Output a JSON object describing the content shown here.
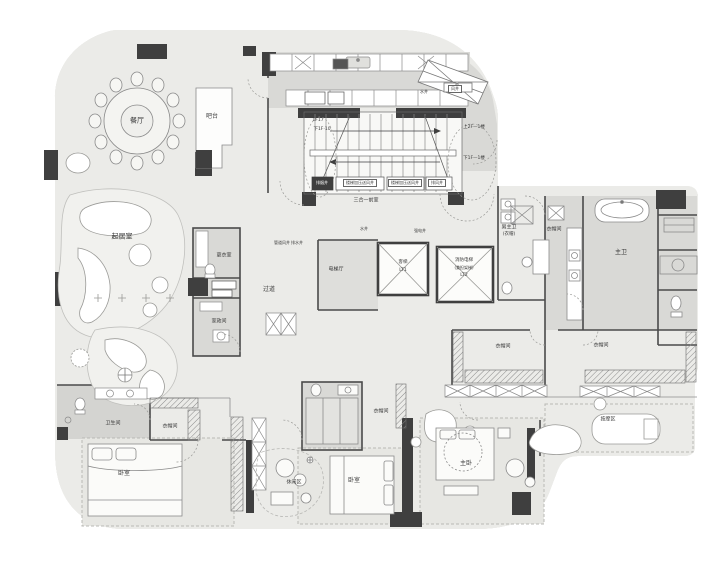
{
  "document": {
    "type": "residential interior floor plan drawing",
    "language": "zh-CN"
  },
  "colors": {
    "background": "#ffffff",
    "floor": "#ebebe8",
    "wet_area": "#d9d9d6",
    "rug": "#e7e7e3",
    "wall_dark": "#3f3f3f",
    "line": "#8c8c8c",
    "furniture_fill": "#fbfbf9"
  },
  "rooms": [
    {
      "id": "dining-room",
      "label": "餐厅",
      "x": 137,
      "y": 121,
      "size": 7
    },
    {
      "id": "bar-counter",
      "label": "吧台",
      "x": 212,
      "y": 117,
      "size": 6
    },
    {
      "id": "living-room",
      "label": "起居室",
      "x": 122,
      "y": 237,
      "size": 7
    },
    {
      "id": "dressing-room",
      "label": "更衣室",
      "x": 224,
      "y": 256,
      "size": 5
    },
    {
      "id": "laundry-room",
      "label": "家政间",
      "x": 219,
      "y": 322,
      "size": 5
    },
    {
      "id": "corridor",
      "label": "过道",
      "x": 269,
      "y": 290,
      "size": 6
    },
    {
      "id": "elevator-hall",
      "label": "电梯厅",
      "x": 336,
      "y": 270,
      "size": 5
    },
    {
      "id": "vestibule",
      "label": "三合一前室",
      "x": 366,
      "y": 201,
      "size": 5
    },
    {
      "id": "male-master-bath",
      "label": "男主卫",
      "x": 509,
      "y": 228,
      "size": 5
    },
    {
      "id": "male-master-bath-sub",
      "label": "(衣帽)",
      "x": 509,
      "y": 235,
      "size": 4.5
    },
    {
      "id": "closet-a",
      "label": "衣帽间",
      "x": 554,
      "y": 230,
      "size": 5
    },
    {
      "id": "master-bath",
      "label": "主卫",
      "x": 621,
      "y": 253,
      "size": 6
    },
    {
      "id": "closet-b",
      "label": "衣帽间",
      "x": 503,
      "y": 347,
      "size": 5
    },
    {
      "id": "closet-c",
      "label": "衣帽间",
      "x": 601,
      "y": 346,
      "size": 5
    },
    {
      "id": "massage-area",
      "label": "按摩区",
      "x": 608,
      "y": 420,
      "size": 5
    },
    {
      "id": "master-bedroom",
      "label": "主卧",
      "x": 466,
      "y": 464,
      "size": 6
    },
    {
      "id": "bedroom-2",
      "label": "卧室",
      "x": 354,
      "y": 481,
      "size": 6
    },
    {
      "id": "leisure-area",
      "label": "休闲区",
      "x": 294,
      "y": 483,
      "size": 5
    },
    {
      "id": "bedroom-3",
      "label": "卧室",
      "x": 124,
      "y": 474,
      "size": 6
    },
    {
      "id": "bathroom-2",
      "label": "卫生间",
      "x": 113,
      "y": 424,
      "size": 5
    },
    {
      "id": "closet-d",
      "label": "衣帽间",
      "x": 170,
      "y": 427,
      "size": 5
    },
    {
      "id": "closet-e",
      "label": "衣帽间",
      "x": 381,
      "y": 412,
      "size": 5
    }
  ],
  "annotations": [
    {
      "id": "stair-up-note",
      "label": "上2F—1楼",
      "x": 474,
      "y": 128,
      "size": 4.5,
      "style": ""
    },
    {
      "id": "stair-down-note",
      "label": "下1F—1楼",
      "x": 474,
      "y": 159,
      "size": 4.5,
      "style": ""
    },
    {
      "id": "stair-up-note-2",
      "label": "1F17",
      "x": 318,
      "y": 121,
      "size": 4.5,
      "style": ""
    },
    {
      "id": "stair-down-note-2",
      "label": "下1F·10",
      "x": 322,
      "y": 130,
      "size": 4.5,
      "style": ""
    },
    {
      "id": "shaft-smoke",
      "label": "排烟井",
      "x": 322,
      "y": 183,
      "size": 4,
      "style": "dark"
    },
    {
      "id": "shaft-stair-press-1",
      "label": "楼梯加压送风井",
      "x": 360,
      "y": 183,
      "size": 4,
      "style": "box"
    },
    {
      "id": "shaft-stair-press-2",
      "label": "楼梯加压送风井",
      "x": 405,
      "y": 183,
      "size": 4,
      "style": "box"
    },
    {
      "id": "shaft-exhaust",
      "label": "排风井",
      "x": 437,
      "y": 183,
      "size": 4,
      "style": "box"
    },
    {
      "id": "shaft-water",
      "label": "水井",
      "x": 364,
      "y": 229,
      "size": 4,
      "style": ""
    },
    {
      "id": "shaft-power",
      "label": "强电井",
      "x": 420,
      "y": 231,
      "size": 4,
      "style": ""
    },
    {
      "id": "shaft-duct",
      "label": "管道风井",
      "x": 282,
      "y": 243,
      "size": 4,
      "style": ""
    },
    {
      "id": "shaft-drain",
      "label": "排水井",
      "x": 297,
      "y": 243,
      "size": 4,
      "style": ""
    },
    {
      "id": "shaft-water-2",
      "label": "水井",
      "x": 424,
      "y": 92,
      "size": 4,
      "style": ""
    },
    {
      "id": "shaft-vent",
      "label": "风井",
      "x": 455,
      "y": 89,
      "size": 4,
      "style": "box"
    },
    {
      "id": "elevator-1-type",
      "label": "客梯",
      "x": 403,
      "y": 263,
      "size": 4.5,
      "style": ""
    },
    {
      "id": "elevator-1-code",
      "label": "LT1",
      "x": 403,
      "y": 271,
      "size": 4.5,
      "style": ""
    },
    {
      "id": "elevator-2-type",
      "label": "消防电梯",
      "x": 464,
      "y": 261,
      "size": 4.5,
      "style": ""
    },
    {
      "id": "elevator-2-sub",
      "label": "(兼担架梯)",
      "x": 464,
      "y": 268,
      "size": 4,
      "style": ""
    },
    {
      "id": "elevator-2-code",
      "label": "LT2",
      "x": 464,
      "y": 276,
      "size": 4.5,
      "style": ""
    }
  ]
}
